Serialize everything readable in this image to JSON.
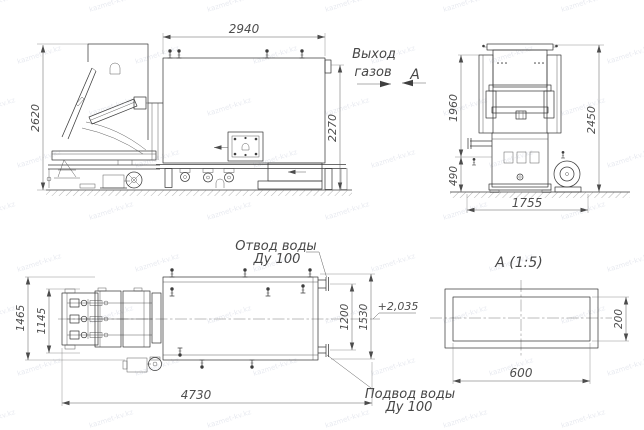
{
  "watermark": {
    "text": "kazmet-kv.kz"
  },
  "side_view": {
    "dims": {
      "top_length": "2940",
      "left_height": "2620",
      "right_height": "2270"
    }
  },
  "front_view": {
    "dims": {
      "upper_height": "1960",
      "overall_height": "2450",
      "lower_height": "490",
      "base_width": "1755"
    }
  },
  "plan_view": {
    "dims": {
      "overall_width": "1465",
      "feeder_width": "1145",
      "overall_length": "4730",
      "port_spacing": "1200",
      "end_width": "1530"
    },
    "elevation_mark": "+2,035",
    "water_outlet_label": {
      "line1": "Отвод воды",
      "line2": "Ду 100"
    },
    "water_inlet_label": {
      "line1": "Подвод воды",
      "line2": "Ду 100"
    }
  },
  "section_a": {
    "title": "А  (1:5)",
    "dims": {
      "width": "600",
      "height": "200"
    }
  },
  "annotations": {
    "gas_outlet": {
      "line1": "Выход",
      "line2": "газов"
    },
    "section_label": "А"
  }
}
